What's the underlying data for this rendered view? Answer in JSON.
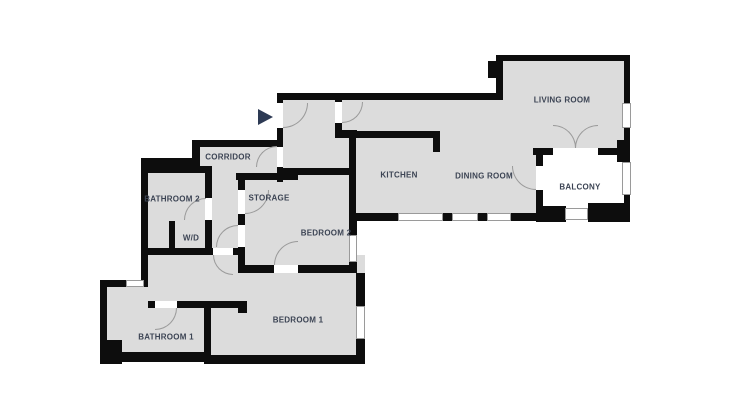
{
  "floorplan": {
    "colors": {
      "wall": "#0d0d0d",
      "floor": "#dcdcdc",
      "background": "#ffffff",
      "label": "#3c4454",
      "entry_arrow": "#2d3a54",
      "frame": "#9a9a9a"
    },
    "rooms": {
      "living_room": "LIVING ROOM",
      "kitchen": "KITCHEN",
      "dining_room": "DINING ROOM",
      "balcony": "BALCONY",
      "corridor": "CORRIDOR",
      "storage": "STORAGE",
      "bathroom_2": "BATHROOM 2",
      "wd": "W/D",
      "bedroom_2": "BEDROOM 2",
      "bedroom_1": "BEDROOM 1",
      "bathroom_1": "BATHROOM 1"
    }
  }
}
